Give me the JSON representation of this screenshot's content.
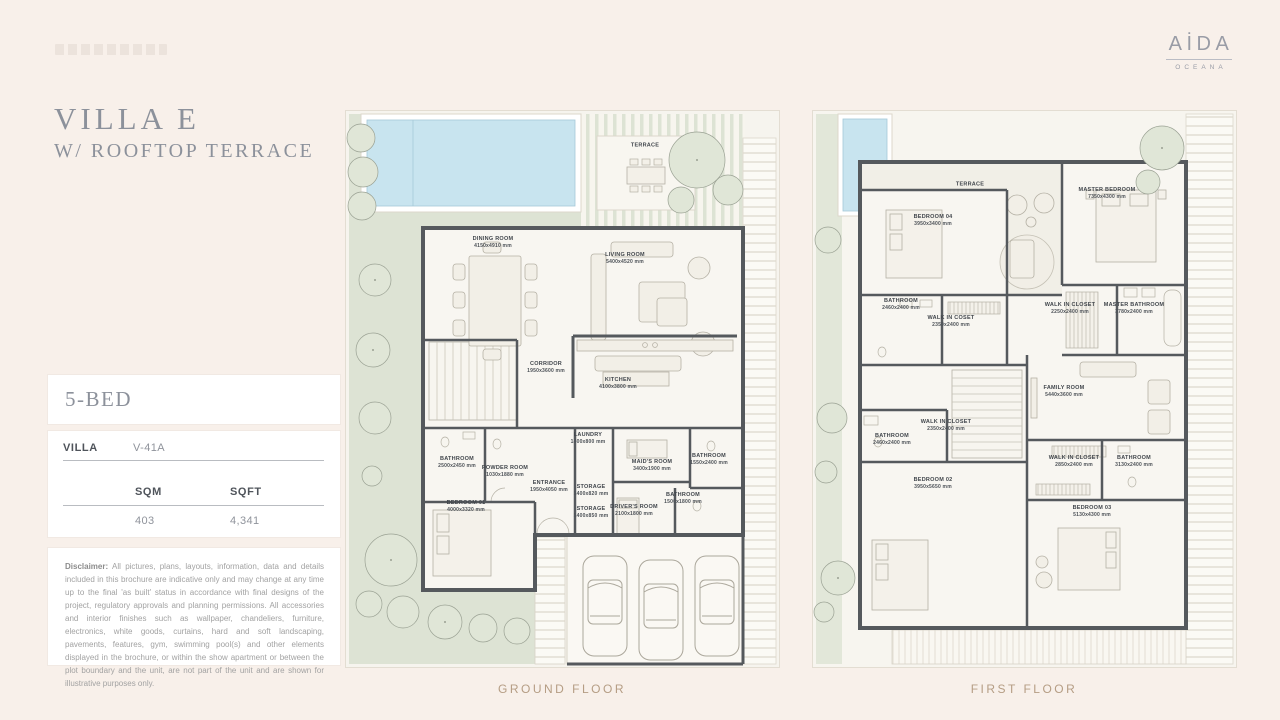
{
  "brand": {
    "name": "AİDA",
    "subtitle": "OCEANA"
  },
  "header": {
    "title": "VILLA E",
    "subtitle": "W/ ROOFTOP TERRACE"
  },
  "spec": {
    "bed": "5-BED",
    "villa_label": "VILLA",
    "villa_value": "V-41A",
    "sqm_label": "SQM",
    "sqft_label": "SQFT",
    "sqm_value": "403",
    "sqft_value": "4,341"
  },
  "disclaimer": {
    "label": "Disclaimer:",
    "text": "All pictures, plans, layouts, information, data and details included in this brochure are indicative only and may change at any time up to the final 'as built' status in accordance with final designs of the project, regulatory approvals and planning permissions. All accessories and interior finishes such as wallpaper, chandeliers, furniture, electronics, white goods, curtains, hard and soft landscaping, pavements, features, gym, swimming pool(s) and other elements displayed in the brochure, or within the show apartment or between the plot boundary and the unit, are not part of the unit and are shown for illustrative purposes only."
  },
  "captions": {
    "ground": "GROUND FLOOR",
    "first": "FIRST FLOOR"
  },
  "plans": {
    "ground": {
      "rooms": [
        {
          "name": "TERRACE",
          "dims": ""
        },
        {
          "name": "DINING ROOM",
          "dims": "4150x4910 mm"
        },
        {
          "name": "LIVING ROOM",
          "dims": "5400x4520 mm"
        },
        {
          "name": "CORRIDOR",
          "dims": "1950x3600 mm"
        },
        {
          "name": "KITCHEN",
          "dims": "4100x3800 mm"
        },
        {
          "name": "LAUNDRY",
          "dims": "1400x800 mm"
        },
        {
          "name": "BATHROOM",
          "dims": "2500x2450 mm"
        },
        {
          "name": "POWDER ROOM",
          "dims": "1030x1880 mm"
        },
        {
          "name": "ENTRANCE",
          "dims": "1950x4050 mm"
        },
        {
          "name": "BEDROOM 01",
          "dims": "4000x3320 mm"
        },
        {
          "name": "STORAGE",
          "dims": "1400x820 mm"
        },
        {
          "name": "STORAGE",
          "dims": "1400x850 mm"
        },
        {
          "name": "MAID'S ROOM",
          "dims": "3400x1900 mm"
        },
        {
          "name": "DRIVER'S ROOM",
          "dims": "2100x1800 mm"
        },
        {
          "name": "BATHROOM",
          "dims": "1500x1800 mm"
        },
        {
          "name": "BATHROOM",
          "dims": "1550x2400 mm"
        }
      ]
    },
    "first": {
      "rooms": [
        {
          "name": "TERRACE",
          "dims": ""
        },
        {
          "name": "BEDROOM 04",
          "dims": "3950x3400 mm"
        },
        {
          "name": "MASTER BEDROOM",
          "dims": "7350x4300 mm"
        },
        {
          "name": "BATHROOM",
          "dims": "2460x2400 mm"
        },
        {
          "name": "WALK IN COSET",
          "dims": "2350x2400 mm"
        },
        {
          "name": "WALK IN CLOSET",
          "dims": "2250x2400 mm"
        },
        {
          "name": "MASTER BATHROOM",
          "dims": "3780x2400 mm"
        },
        {
          "name": "FAMILY ROOM",
          "dims": "5440x3600 mm"
        },
        {
          "name": "BATHROOM",
          "dims": "2460x2400 mm"
        },
        {
          "name": "WALK IN CLOSET",
          "dims": "2350x2400 mm"
        },
        {
          "name": "BEDROOM 02",
          "dims": "3950x5650 mm"
        },
        {
          "name": "WALK IN CLOSET",
          "dims": "2850x2400 mm"
        },
        {
          "name": "BATHROOM",
          "dims": "3130x2400 mm"
        },
        {
          "name": "BEDROOM 03",
          "dims": "5130x4300 mm"
        }
      ]
    }
  },
  "colors": {
    "page_bg": "#f8f0ea",
    "panel_bg": "#ffffff",
    "accent_text": "#8c919b",
    "caption": "#b59d84",
    "wall": "#55595d",
    "garden": "#dde3d4",
    "pool": "#c8e4ef"
  }
}
